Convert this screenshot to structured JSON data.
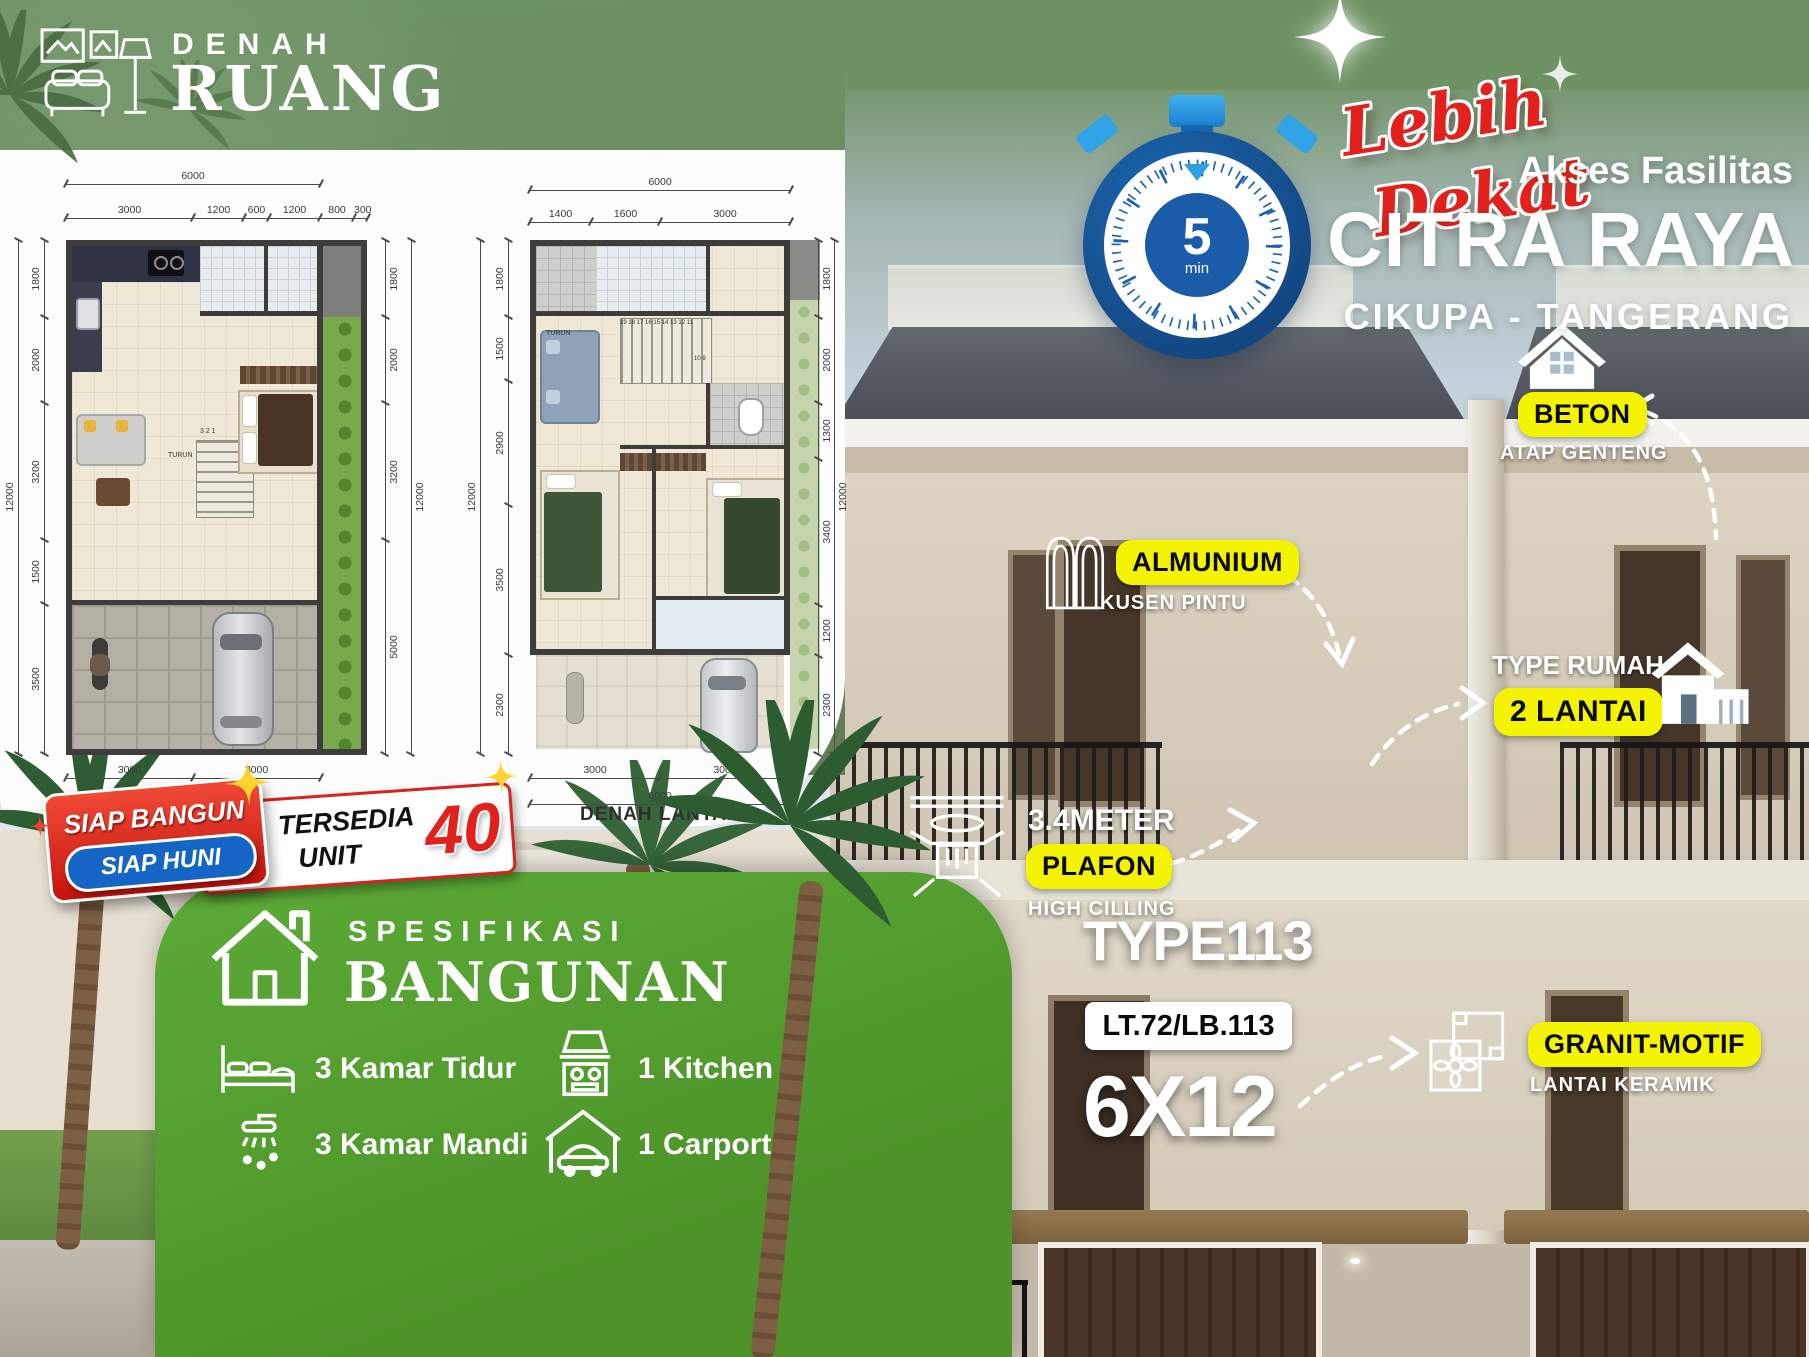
{
  "header": {
    "line1": "DENAH",
    "line2": "RUANG"
  },
  "plans": {
    "plan1": {
      "caption": "DENAH LANTAI 1",
      "top_total": [
        "6000"
      ],
      "top": [
        "3000",
        "1200",
        "600",
        "1200",
        "800",
        "300"
      ],
      "left_total": [
        "12000"
      ],
      "left": [
        "1800",
        "2000",
        "3200",
        "1500",
        "3500"
      ],
      "right_total": [
        "12000"
      ],
      "right": [
        "1800",
        "2000",
        "3200",
        "5000"
      ],
      "bottom": [
        "3000",
        "3000"
      ],
      "bottom_total": [
        "6000"
      ],
      "stair_label": "TURUN",
      "stair_numbers": "3 2 1"
    },
    "plan2": {
      "caption": "DENAH LANTAI 2",
      "top_total": [
        "6000"
      ],
      "top": [
        "1400",
        "1600",
        "3000"
      ],
      "left_total": [
        "12000"
      ],
      "left": [
        "1800",
        "1500",
        "2900",
        "3500",
        "2300"
      ],
      "right_total": [
        "12000"
      ],
      "right": [
        "1800",
        "2000",
        "1300",
        "3400",
        "1200",
        "2300"
      ],
      "bottom": [
        "3000",
        "3000"
      ],
      "bottom_total": [
        "6000"
      ],
      "stair_label": "TURUN",
      "stair_numbers_top": "19 18 17 16 15 14 13 12 11",
      "stair_numbers_side": "10 9"
    }
  },
  "promo": {
    "script1": "Lebih",
    "script2": "Dekat",
    "akses": "Akses Fasilitas",
    "brand": "CITRA RAYA",
    "location": "CIKUPA - TANGERANG",
    "timer_value": "5",
    "timer_unit": "min"
  },
  "callouts": {
    "beton": {
      "label": "BETON",
      "sub": "ATAP GENTENG"
    },
    "almunium": {
      "label": "ALMUNIUM",
      "sub": "KUSEN PINTU"
    },
    "lantai": {
      "title": "TYPE RUMAH",
      "label": "2 LANTAI"
    },
    "plafon": {
      "title": "3.4METER",
      "label": "PLAFON",
      "sub": "HIGH CILLING"
    },
    "granit": {
      "label": "GRANIT-MOTIF",
      "sub": "LANTAI KERAMIK"
    }
  },
  "ribbon": {
    "line1": "SIAP BANGUN",
    "line2": "SIAP HUNI",
    "tersedia": "TERSEDIA",
    "unit": "UNIT",
    "count": "40"
  },
  "spec": {
    "title1": "SPESIFIKASI",
    "title2": "BANGUNAN",
    "items": [
      {
        "label": "3 Kamar Tidur"
      },
      {
        "label": "3 Kamar Mandi"
      },
      {
        "label": "1 Kitchen"
      },
      {
        "label": "1 Carport"
      }
    ]
  },
  "type_info": {
    "type": "TYPE113",
    "ltlb": "LT.72/LB.113",
    "size": "6X12"
  },
  "colors": {
    "accent_yellow": "#f4f400",
    "brand_green": "#55a033",
    "bg_green": "#6d9163",
    "red": "#e3211c",
    "timer_blue": "#1b5ca8"
  }
}
